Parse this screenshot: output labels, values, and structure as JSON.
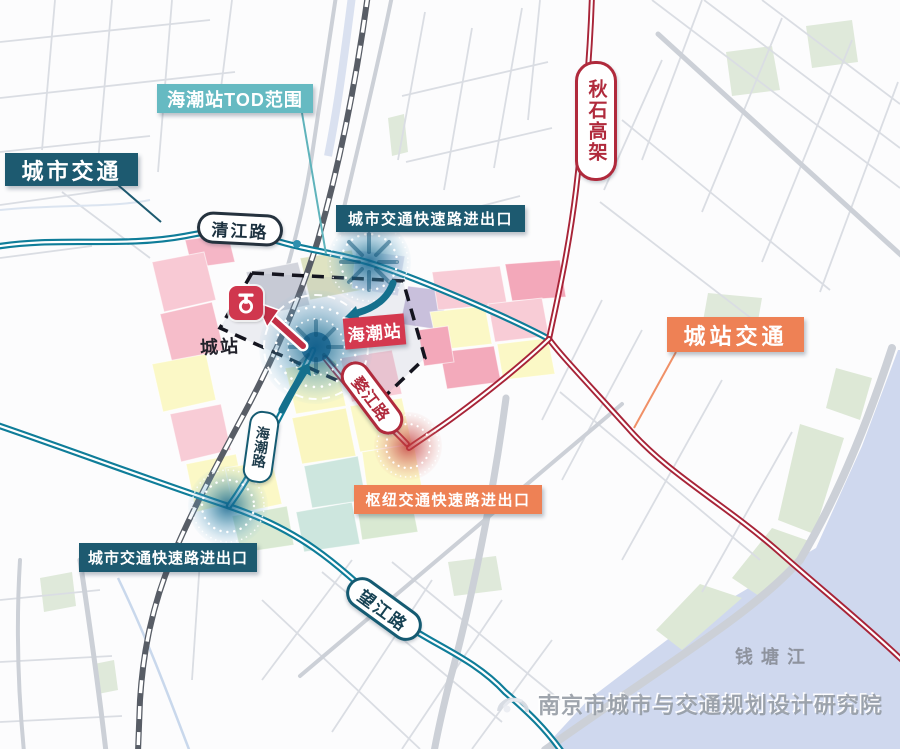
{
  "map": {
    "labels": {
      "tod_scope": "海潮站TOD范围",
      "urban_traffic": "城市交通",
      "qingjiang_road": "清江路",
      "qiushi_viaduct": "秋石高架",
      "urban_expwy_exit_top": "城市交通快速路进出口",
      "haichao_station": "海潮站",
      "chengzhan": "城站",
      "chengzhan_traffic": "城站交通",
      "wujiang_road": "婺江路",
      "haichao_road": "海潮路",
      "hub_expwy_exit": "枢纽交通快速路进出口",
      "urban_expwy_exit_bottom": "城市交通快速路进出口",
      "wangjiang_road": "望江路",
      "qiantang_river": "钱塘江"
    },
    "watermark": {
      "text": "南京市城市与交通规划设计研究院"
    },
    "colors": {
      "urban_traffic_teal": "#1d5a70",
      "tod_teal": "#66bac2",
      "road_teal": "#0f7d99",
      "station_red": "#d4394f",
      "road_red": "#a82438",
      "hub_orange": "#ee8155",
      "river_blue": "#cfd8ee"
    }
  }
}
